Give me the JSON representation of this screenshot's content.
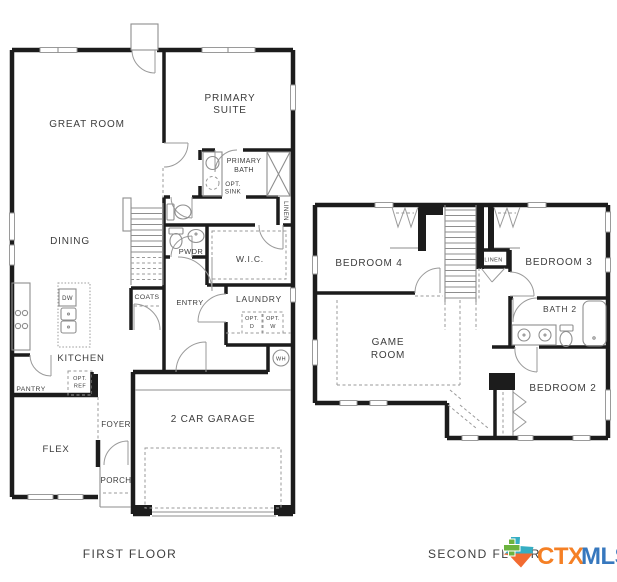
{
  "page": {
    "background": "#ffffff"
  },
  "first_floor": {
    "caption": "FIRST FLOOR",
    "labels": {
      "great_room": "GREAT ROOM",
      "primary_suite": [
        "PRIMARY",
        "SUITE"
      ],
      "primary_bath": [
        "PRIMARY",
        "BATH"
      ],
      "opt_sink": [
        "OPT.",
        "SINK"
      ],
      "linen": "LINEN",
      "wic": "W.I.C.",
      "pwdr": "PWDR",
      "dining": "DINING",
      "coats": "COATS",
      "entry": "ENTRY",
      "laundry": "LAUNDRY",
      "opt_d": [
        "OPT.",
        "D"
      ],
      "opt_w": [
        "OPT.",
        "W"
      ],
      "wh": "WH",
      "dw": "DW",
      "kitchen": "KITCHEN",
      "pantry": "PANTRY",
      "opt_ref": [
        "OPT.",
        "REF"
      ],
      "foyer": "FOYER",
      "flex": "FLEX",
      "porch": "PORCH",
      "garage": "2 CAR GARAGE"
    }
  },
  "second_floor": {
    "caption": "SECOND FLOOR",
    "labels": {
      "bedroom_4": "BEDROOM 4",
      "bedroom_3": "BEDROOM 3",
      "linen": "LINEN",
      "bath_2": "BATH 2",
      "game_room": [
        "GAME",
        "ROOM"
      ],
      "bedroom_2": "BEDROOM 2"
    }
  },
  "watermark": {
    "ctx": "CTX",
    "mls": "MLS",
    "ctx_color": "#F58025",
    "mls_color": "#3778BE",
    "texas_green": "#6CB33F",
    "texas_teal": "#35AEC3",
    "texas_orange": "#F26B31"
  },
  "colors": {
    "wall": "#1c1c1c",
    "fixture": "#8e8e8e",
    "text": "#3d3d3d"
  }
}
